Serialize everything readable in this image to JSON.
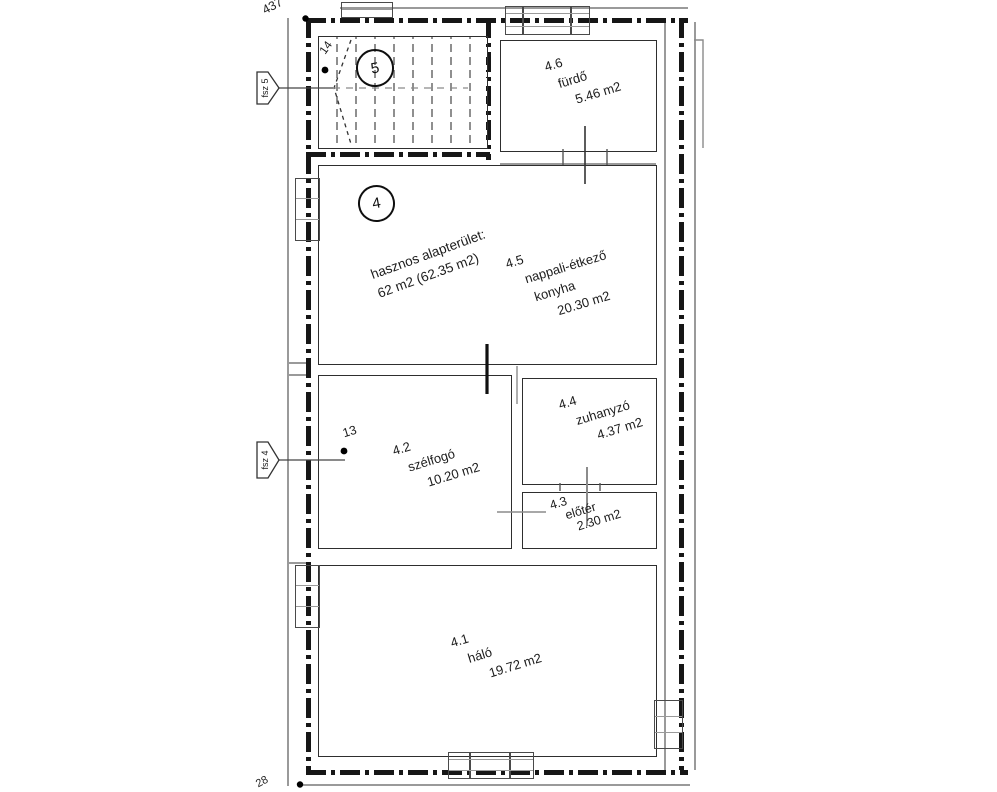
{
  "plan": {
    "dim_top": "437",
    "dim_bottom": "28",
    "stair_step_ref": "14",
    "door_ref": "13",
    "unit_circle_main": "4",
    "unit_circle_stair": "5",
    "tag_upper": "fsz 5",
    "tag_lower": "fsz 4",
    "summary_line1": "hasznos alapterület:",
    "summary_line2": "62 m2 (62.35 m2)",
    "rooms": [
      {
        "id": "4.1",
        "name_lines": [
          "háló"
        ],
        "area": "19.72 m2"
      },
      {
        "id": "4.2",
        "name_lines": [
          "szélfogó"
        ],
        "area": "10.20 m2"
      },
      {
        "id": "4.3",
        "name_lines": [
          "előtér"
        ],
        "area": "2.30 m2"
      },
      {
        "id": "4.4",
        "name_lines": [
          "zuhanyzó"
        ],
        "area": "4.37 m2"
      },
      {
        "id": "4.5",
        "name_lines": [
          "nappali-étkező",
          "konyha"
        ],
        "area": "20.30 m2"
      },
      {
        "id": "4.6",
        "name_lines": [
          "fürdő"
        ],
        "area": "5.46 m2"
      }
    ]
  }
}
